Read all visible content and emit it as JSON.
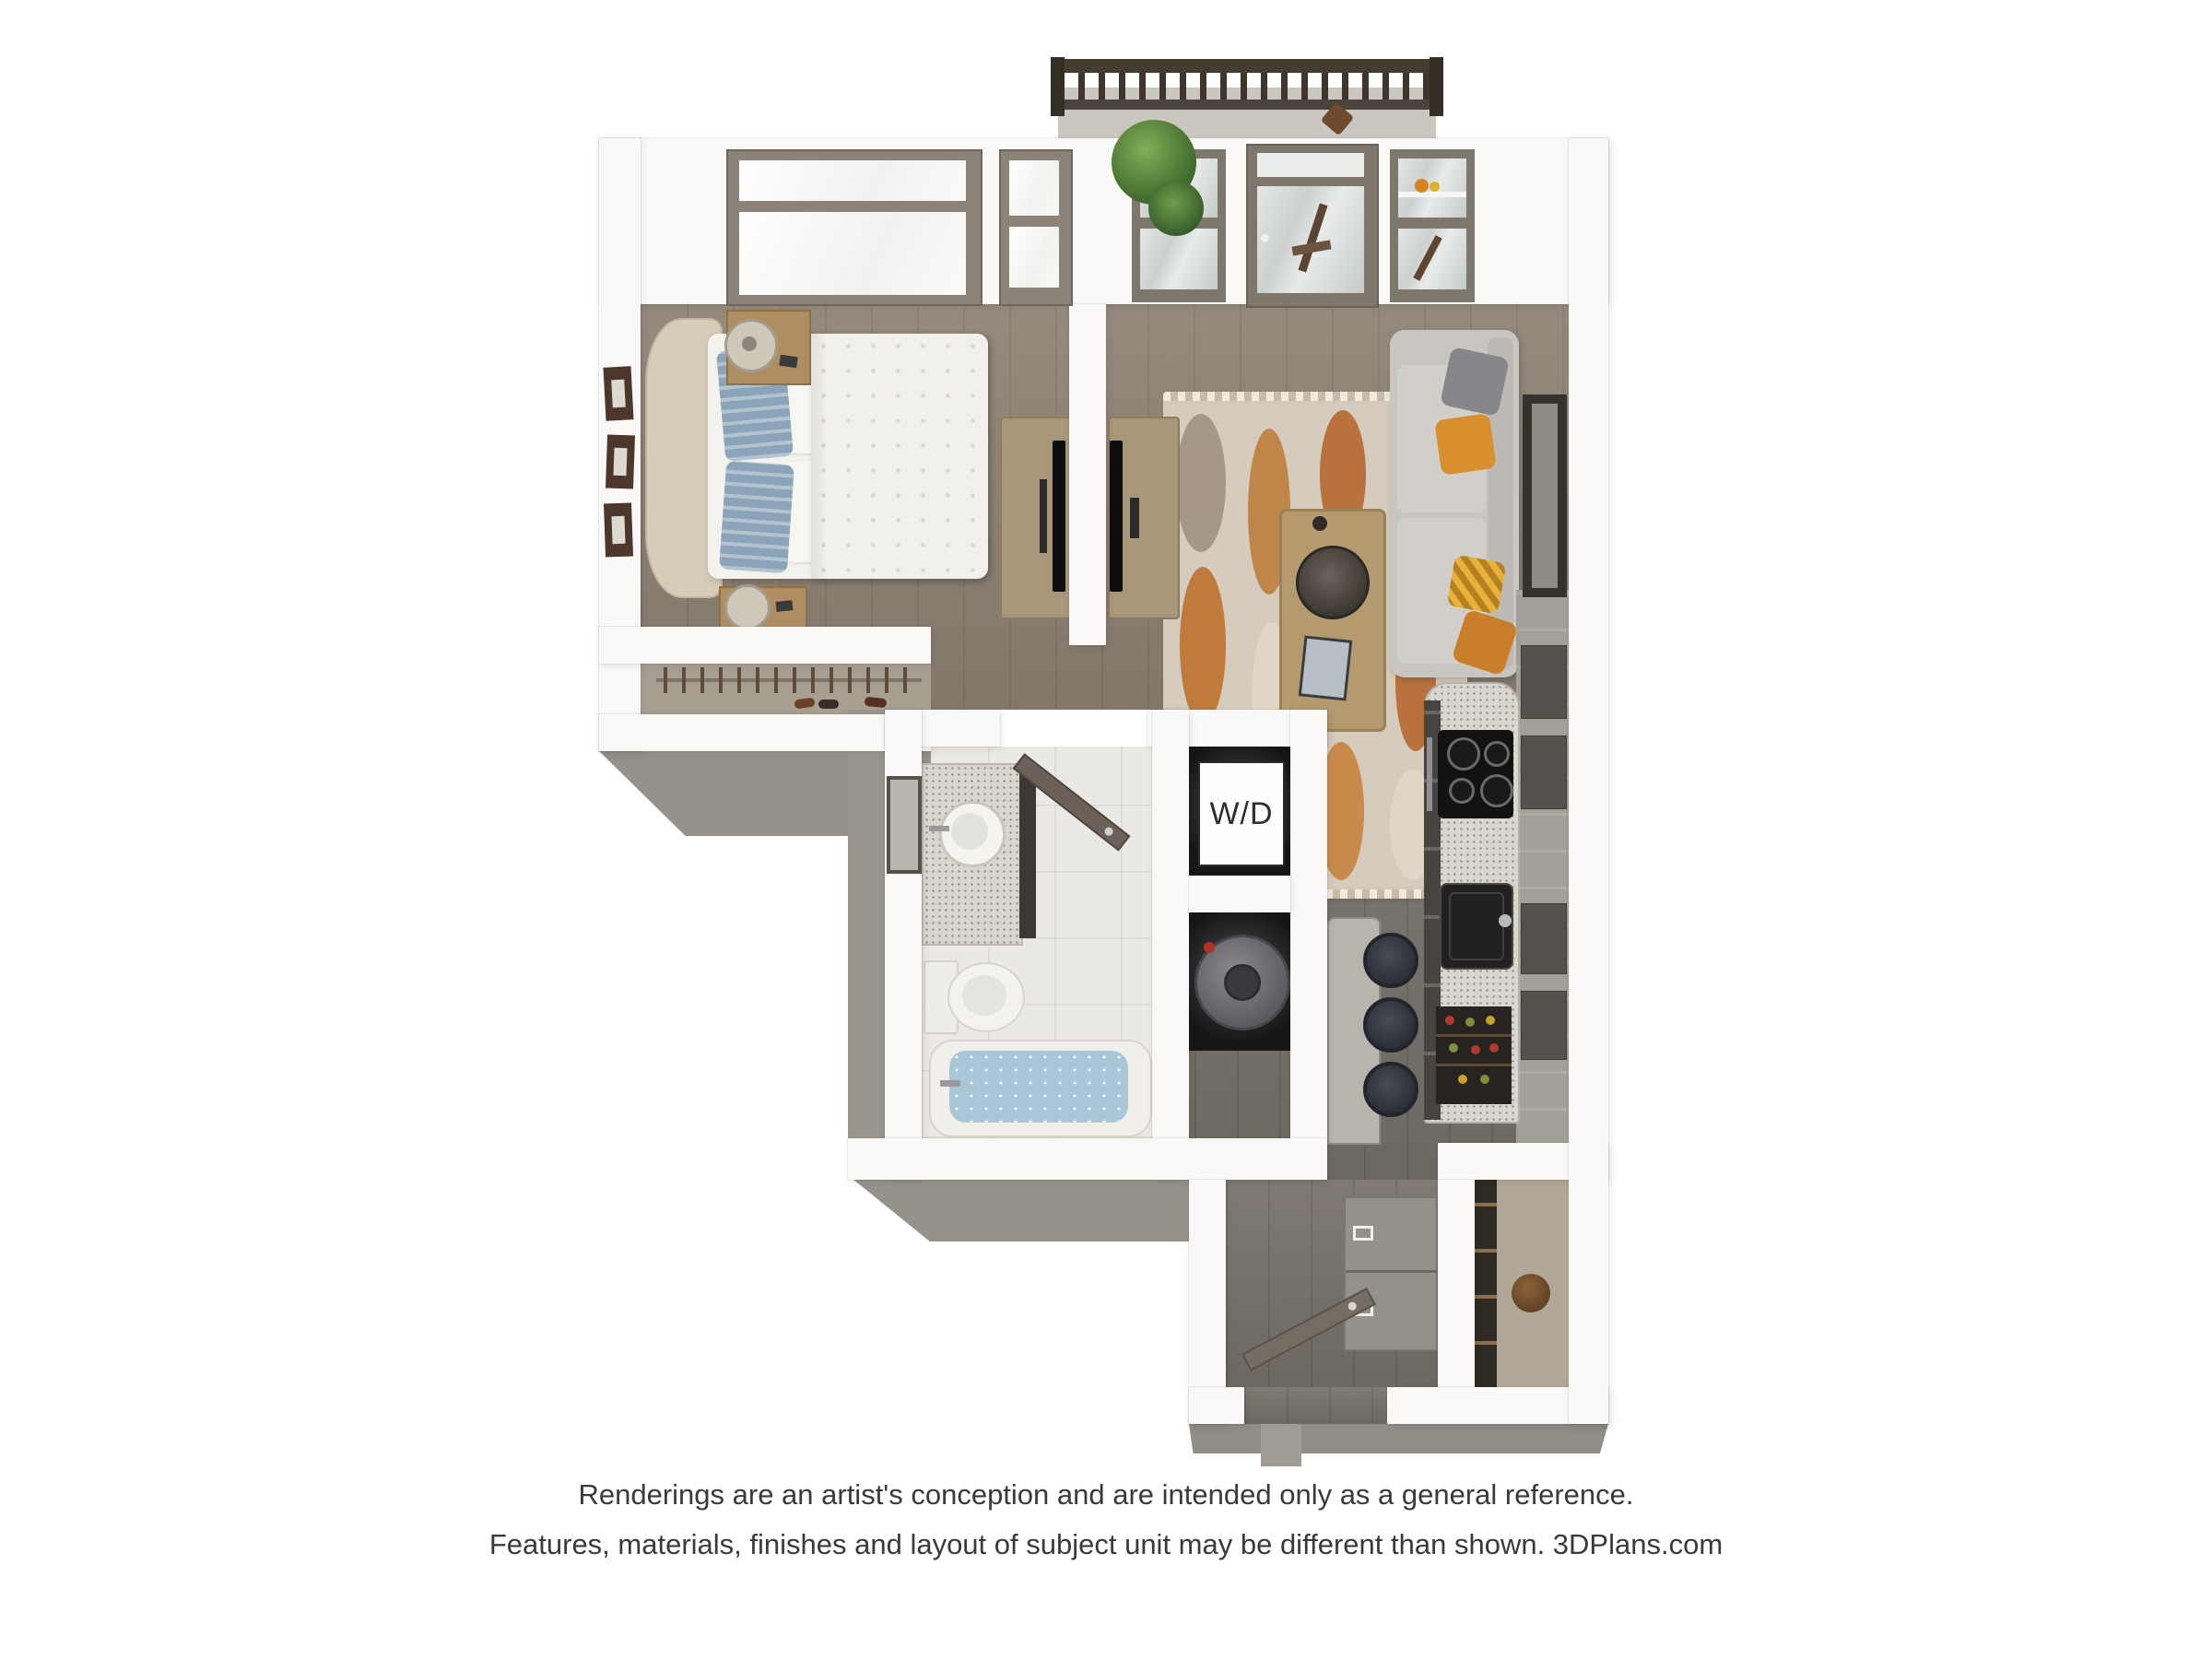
{
  "disclaimer": {
    "line1": "Renderings are an artist's conception and are intended only as a general reference.",
    "line2": "Features, materials, finishes and layout of subject unit may be different than shown. 3DPlans.com"
  },
  "labels": {
    "washer_dryer": "W/D"
  },
  "colors": {
    "background": "#ffffff",
    "wall": "#faf9f7",
    "wall_outer_face": "#96928b",
    "wood_floor_main": "#8d8174",
    "wood_floor_kitchen": "#79736c",
    "bathroom_marble": "#ebe9e5",
    "tub_water": "#a9c7d6",
    "sofa_gray": "#c9c6c1",
    "pillow_orange": "#d78f2f",
    "rug_orange": "#b9713d",
    "balcony_railing": "#443b31",
    "window_frame": "#7e776e",
    "caption_text": "#3a3a3a"
  }
}
